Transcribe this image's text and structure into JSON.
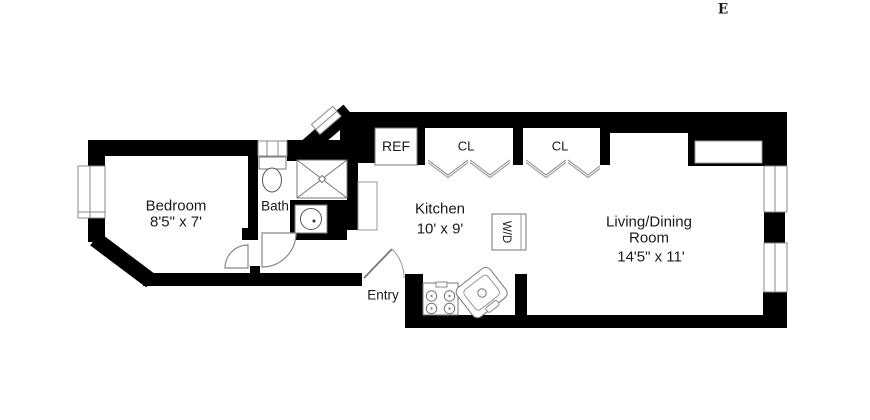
{
  "compass": {
    "east_label": "E"
  },
  "rooms": {
    "bedroom": {
      "name": "Bedroom",
      "dims": "8'5\" x 7'"
    },
    "bath": {
      "name": "Bath"
    },
    "kitchen": {
      "name": "Kitchen",
      "dims": "10' x 9'"
    },
    "living_dining": {
      "name_line1": "Living/Dining",
      "name_line2": "Room",
      "dims": "14'5\" x 11'"
    },
    "entry": {
      "name": "Entry"
    }
  },
  "closets_appliances": {
    "refrigerator": "REF",
    "closet_left": "CL",
    "closet_right": "CL",
    "washer_dryer": "W/D"
  },
  "colors": {
    "wall": "#000000",
    "fixture_line": "#777777",
    "text": "#1a1a1a",
    "background": "#ffffff"
  }
}
